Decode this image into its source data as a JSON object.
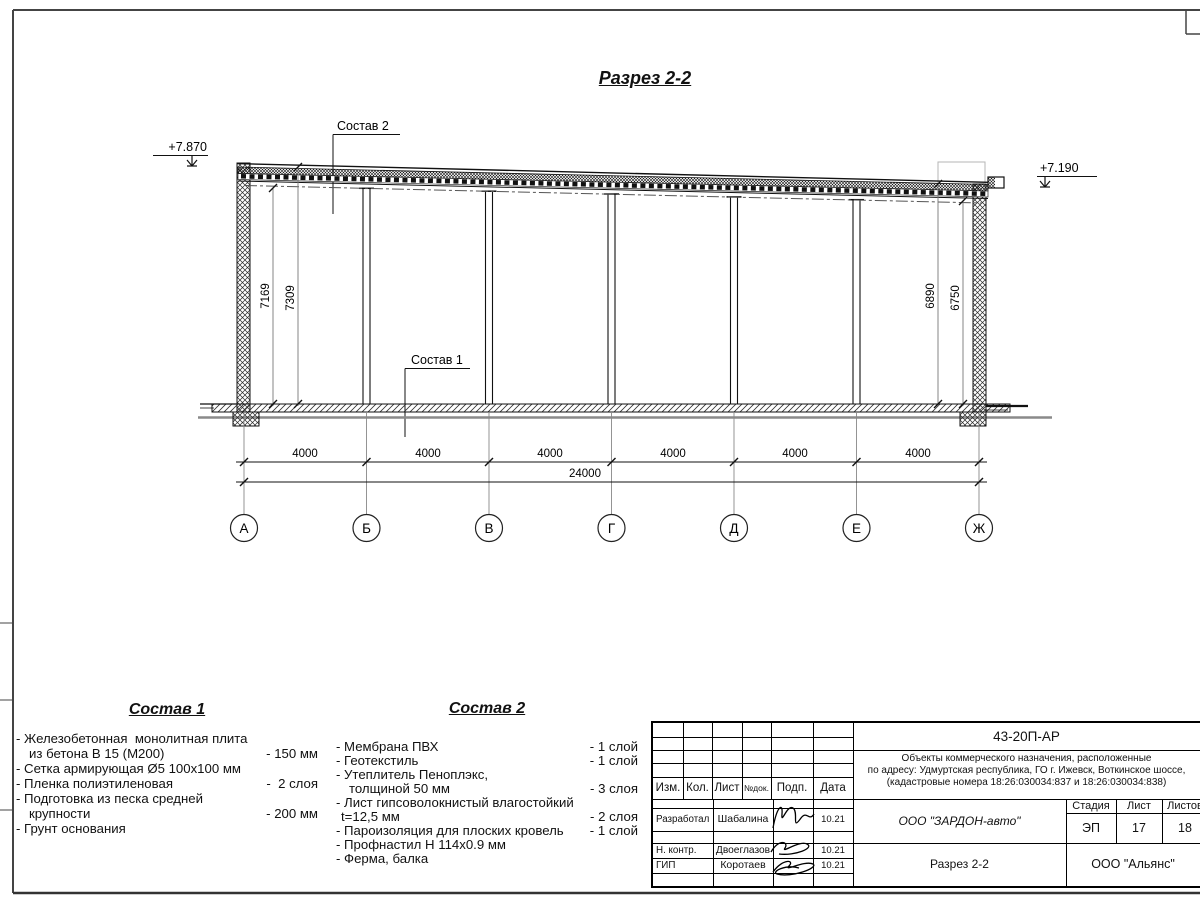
{
  "drawing": {
    "title": "Разрез 2-2",
    "elevation_left": "+7.870",
    "elevation_right": "+7.190",
    "leader_top": "Состав 2",
    "leader_floor": "Состав 1",
    "dim_left_inner": "7169",
    "dim_left_outer": "7309",
    "dim_right_outer": "6890",
    "dim_right_inner": "6750",
    "bay_dims": [
      "4000",
      "4000",
      "4000",
      "4000",
      "4000",
      "4000"
    ],
    "total_dim": "24000",
    "axes": [
      "А",
      "Б",
      "В",
      "Г",
      "Д",
      "Е",
      "Ж"
    ]
  },
  "sostav1": {
    "title": "Состав 1",
    "items": [
      {
        "text": "- Железобетонная  монолитная плита",
        "value": ""
      },
      {
        "text": "из бетона В 15 (М200)",
        "value": "- 150 мм"
      },
      {
        "text": "- Сетка армирующая Ø5 100х100 мм",
        "value": ""
      },
      {
        "text": "- Пленка полиэтиленовая",
        "value": "-  2 слоя"
      },
      {
        "text": "- Подготовка из песка средней",
        "value": ""
      },
      {
        "text": "крупности",
        "value": "- 200 мм"
      },
      {
        "text": "- Грунт основания",
        "value": ""
      }
    ]
  },
  "sostav2": {
    "title": "Состав 2",
    "items": [
      {
        "text": "- Мембрана ПВХ",
        "value": "- 1 слой"
      },
      {
        "text": "- Геотекстиль",
        "value": "- 1 слой"
      },
      {
        "text": "- Утеплитель Пеноплэкс,",
        "value": ""
      },
      {
        "text": "толщиной 50 мм",
        "value": "- 3 слоя"
      },
      {
        "text": "- Лист гипсоволокнистый влагостойкий",
        "value": ""
      },
      {
        "text": "t=12,5 мм",
        "value": "- 2 слоя"
      },
      {
        "text": "- Пароизоляция для плоских кровель",
        "value": "- 1 слой"
      },
      {
        "text": "- Профнастил Н 114х0.9 мм",
        "value": ""
      },
      {
        "text": "- Ферма, балка",
        "value": ""
      }
    ]
  },
  "titleblock": {
    "doc_code": "43-20П-АР",
    "project_lines": [
      "Объекты коммерческого назначения, расположенные",
      "по адресу: Удмуртская республика, ГО г. Ижевск, Воткинское шоссе,",
      "(кадастровые номера 18:26:030034:837 и 18:26:030034:838)"
    ],
    "col_headers": [
      "Изм.",
      "Кол.",
      "Лист",
      "№док.",
      "Подп.",
      "Дата"
    ],
    "staff": [
      {
        "role": "Разработал",
        "name": "Шабалина",
        "date": "10.21"
      },
      {
        "role": "Н. контр.",
        "name": "Двоеглазов",
        "date": "10.21"
      },
      {
        "role": "ГИП",
        "name": "Коротаев",
        "date": "10.21"
      }
    ],
    "company": "ООО \"ЗАРДОН-авто\"",
    "sheet_title": "Разрез 2-2",
    "contractor": "ООО \"Альянс\"",
    "stage_label": "Стадия",
    "list_label": "Лист",
    "listov_label": "Листов",
    "stage": "ЭП",
    "sheet_no": "17",
    "sheet_total": "18"
  }
}
